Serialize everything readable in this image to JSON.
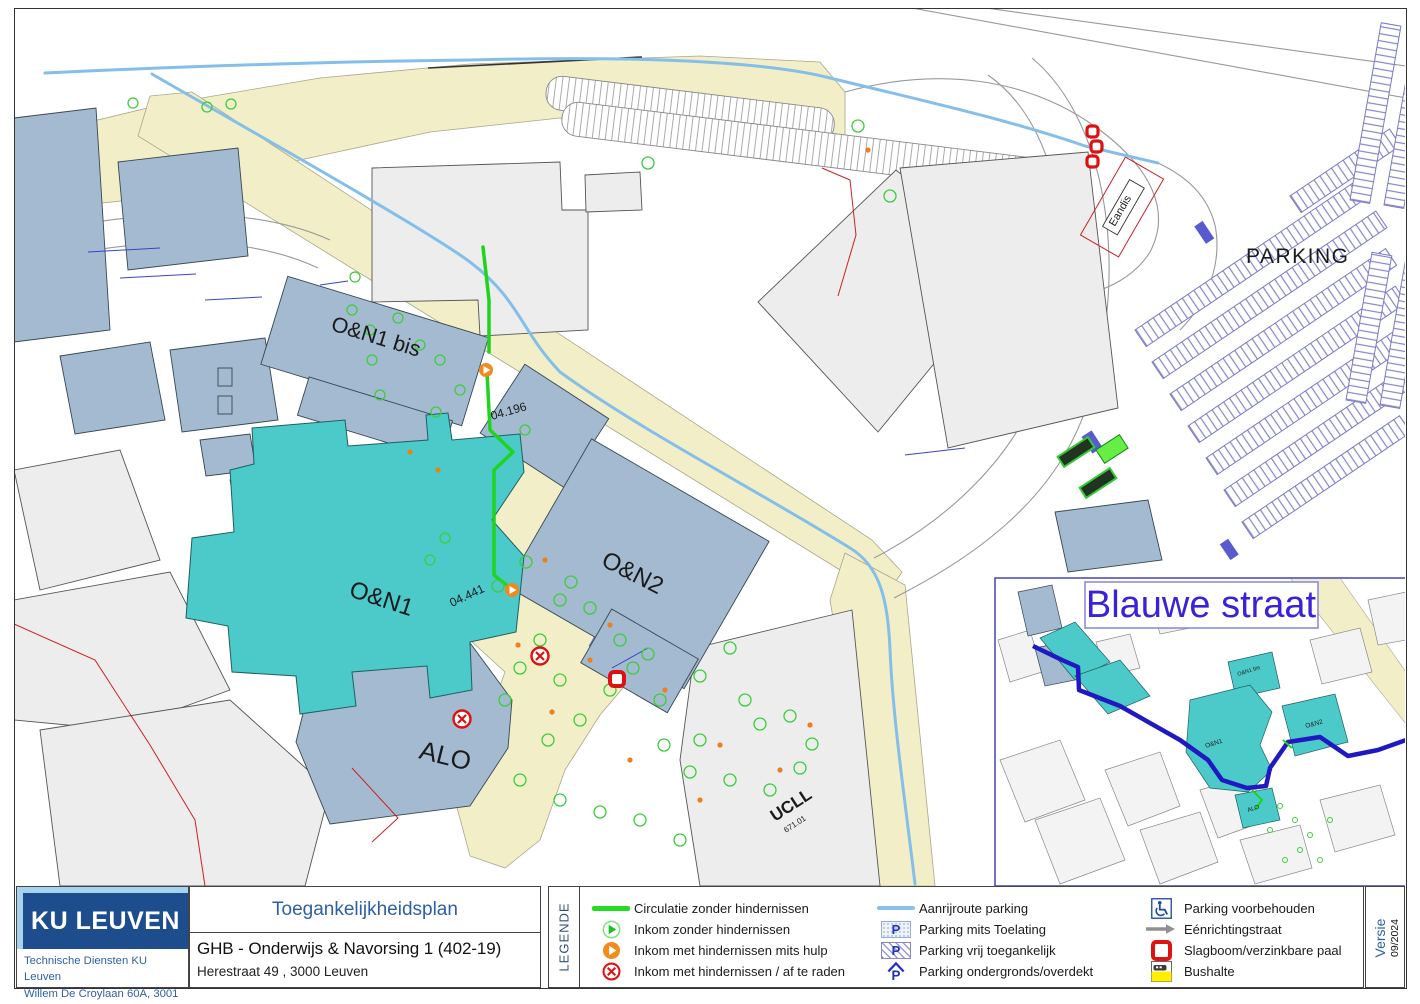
{
  "map": {
    "labels": {
      "on1bis": "O&N1 bis",
      "on1": "O&N1",
      "on2": "O&N2",
      "alo": "ALO",
      "ucll": "UCLL",
      "ucll_code": "671.01",
      "parking": "PARKING",
      "eandis": "Eandis",
      "room_04_196": "04.196",
      "room_04_441": "04.441"
    },
    "inset": {
      "title": "Blauwe straat",
      "labels": {
        "on1bis": "O&N1 bis",
        "on1": "O&N1",
        "on2": "O&N2",
        "alo": "ALO"
      }
    }
  },
  "footer": {
    "logo": {
      "brand": "KU LEUVEN",
      "dept": "Technische Diensten KU Leuven",
      "address": "Willem De Croylaan 60A, 3001 Heverlee"
    },
    "title_block": {
      "plan_type": "Toegankelijkheidsplan",
      "title": "GHB - Onderwijs & Navorsing 1 (402-19)",
      "address": "Herestraat 49 , 3000 Leuven"
    },
    "legend": {
      "heading": "LEGENDE",
      "items": [
        {
          "icon": "green-line",
          "label": "Circulatie zonder hindernissen"
        },
        {
          "icon": "entrance-ok",
          "label": "Inkom zonder hindernissen"
        },
        {
          "icon": "entrance-help",
          "label": "Inkom met hindernissen mits hulp"
        },
        {
          "icon": "entrance-avoid",
          "label": "Inkom met hindernissen / af te raden"
        },
        {
          "icon": "blue-line",
          "label": "Aanrijroute parking"
        },
        {
          "icon": "parking-permit",
          "label": "Parking mits Toelating"
        },
        {
          "icon": "parking-free",
          "label": "Parking vrij toegankelijk"
        },
        {
          "icon": "parking-underground",
          "label": "Parking ondergronds/overdekt"
        },
        {
          "icon": "parking-reserved",
          "label": "Parking voorbehouden"
        },
        {
          "icon": "one-way",
          "label": "Eénrichtingstraat"
        },
        {
          "icon": "barrier",
          "label": "Slagboom/verzinkbare paal"
        },
        {
          "icon": "bus-stop",
          "label": "Bushalte"
        }
      ]
    },
    "version": {
      "label": "Versie",
      "value": "09/2024"
    }
  },
  "colors": {
    "brand_navy": "#1d4d8c",
    "brand_lightblue": "#a8d3f0",
    "accent_blue_text": "#2d5fa8",
    "building_teal": "#4cc9c9",
    "building_bluegray": "#a4bad1",
    "building_gray": "#ededed",
    "road_beige": "#f2efc8",
    "route_green": "#1fd41f",
    "route_blue": "#85bfe9",
    "parking_stripe": "#7a7ac8",
    "alert_red": "#dd1515",
    "inset_route_blue": "#2018c0",
    "blauwe_straat_text": "#3a22d8"
  }
}
